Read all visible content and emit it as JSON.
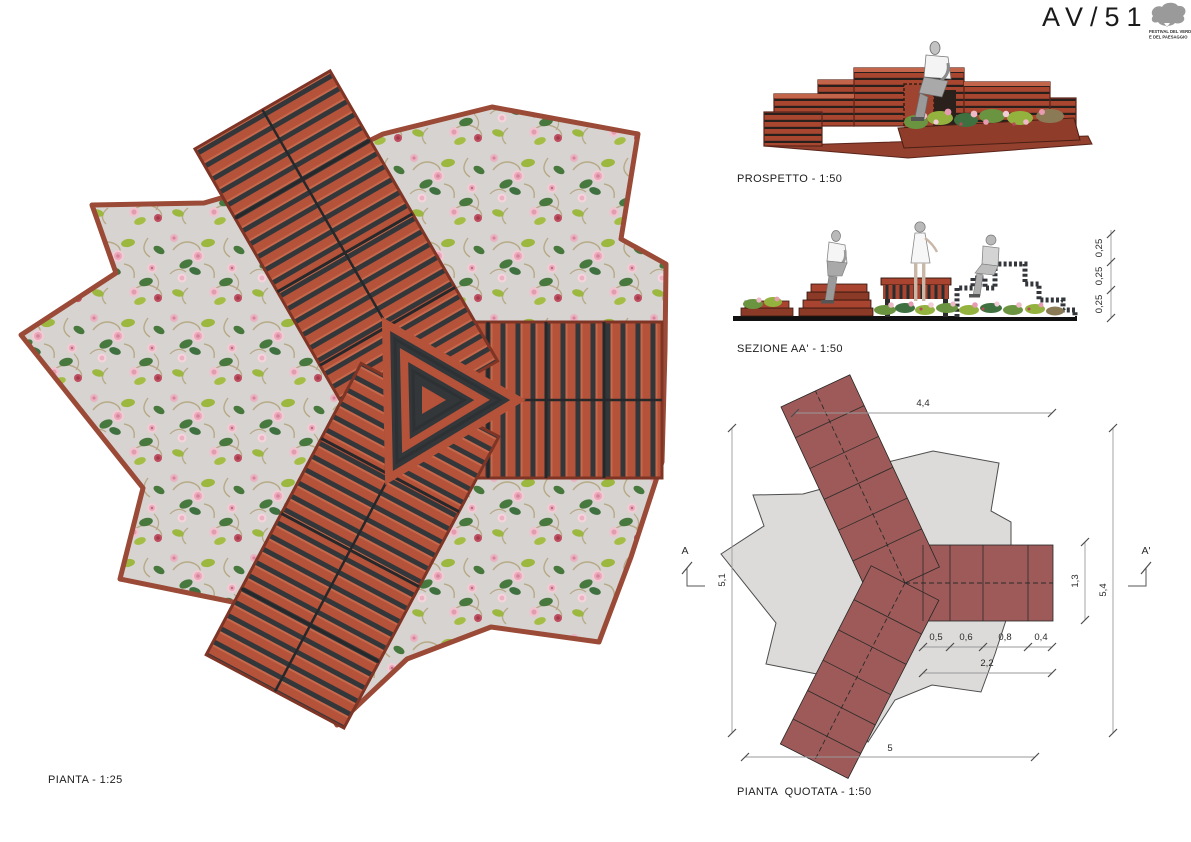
{
  "header": {
    "title": "AV/51",
    "logo": {
      "caption_line1": "FESTIVAL DEL VERDE",
      "caption_line2": "E DEL PAESAGGIO"
    }
  },
  "views": {
    "pianta": {
      "label": "PIANTA - 1:25"
    },
    "prospetto": {
      "label": "PROSPETTO - 1:50"
    },
    "sezione": {
      "label": "SEZIONE AA' - 1:50",
      "dim_heights": [
        "0,25",
        "0,25",
        "0,25"
      ]
    },
    "pianta_quotata": {
      "label": "PIANTA  QUOTATA - 1:50",
      "marker_left": "A",
      "marker_right": "A'",
      "dims": {
        "top": "4,4",
        "left": "5,1",
        "bottom": "5",
        "arm_width": "1,3",
        "right_overall": "5,4",
        "cells": [
          "0,5",
          "0,6",
          "0,8",
          "0,4"
        ],
        "cells_total": "2,2"
      }
    }
  },
  "colors": {
    "wood_red": "#b5523a",
    "wood_frame_dark": "#33373a",
    "plan_maroon": "#9d5a58",
    "star_gray": "#dcdbd9",
    "paving_gray": "#d7d3d0",
    "leaf_dark": "#47793f",
    "leaf_light": "#9cb83f",
    "rose_pink": "#f1c7d2",
    "rose_deep": "#b34a5a",
    "branch_tan": "#b7aa87",
    "figure_gray": "#b9b9b9",
    "logo_gray": "#9a9a9a"
  }
}
